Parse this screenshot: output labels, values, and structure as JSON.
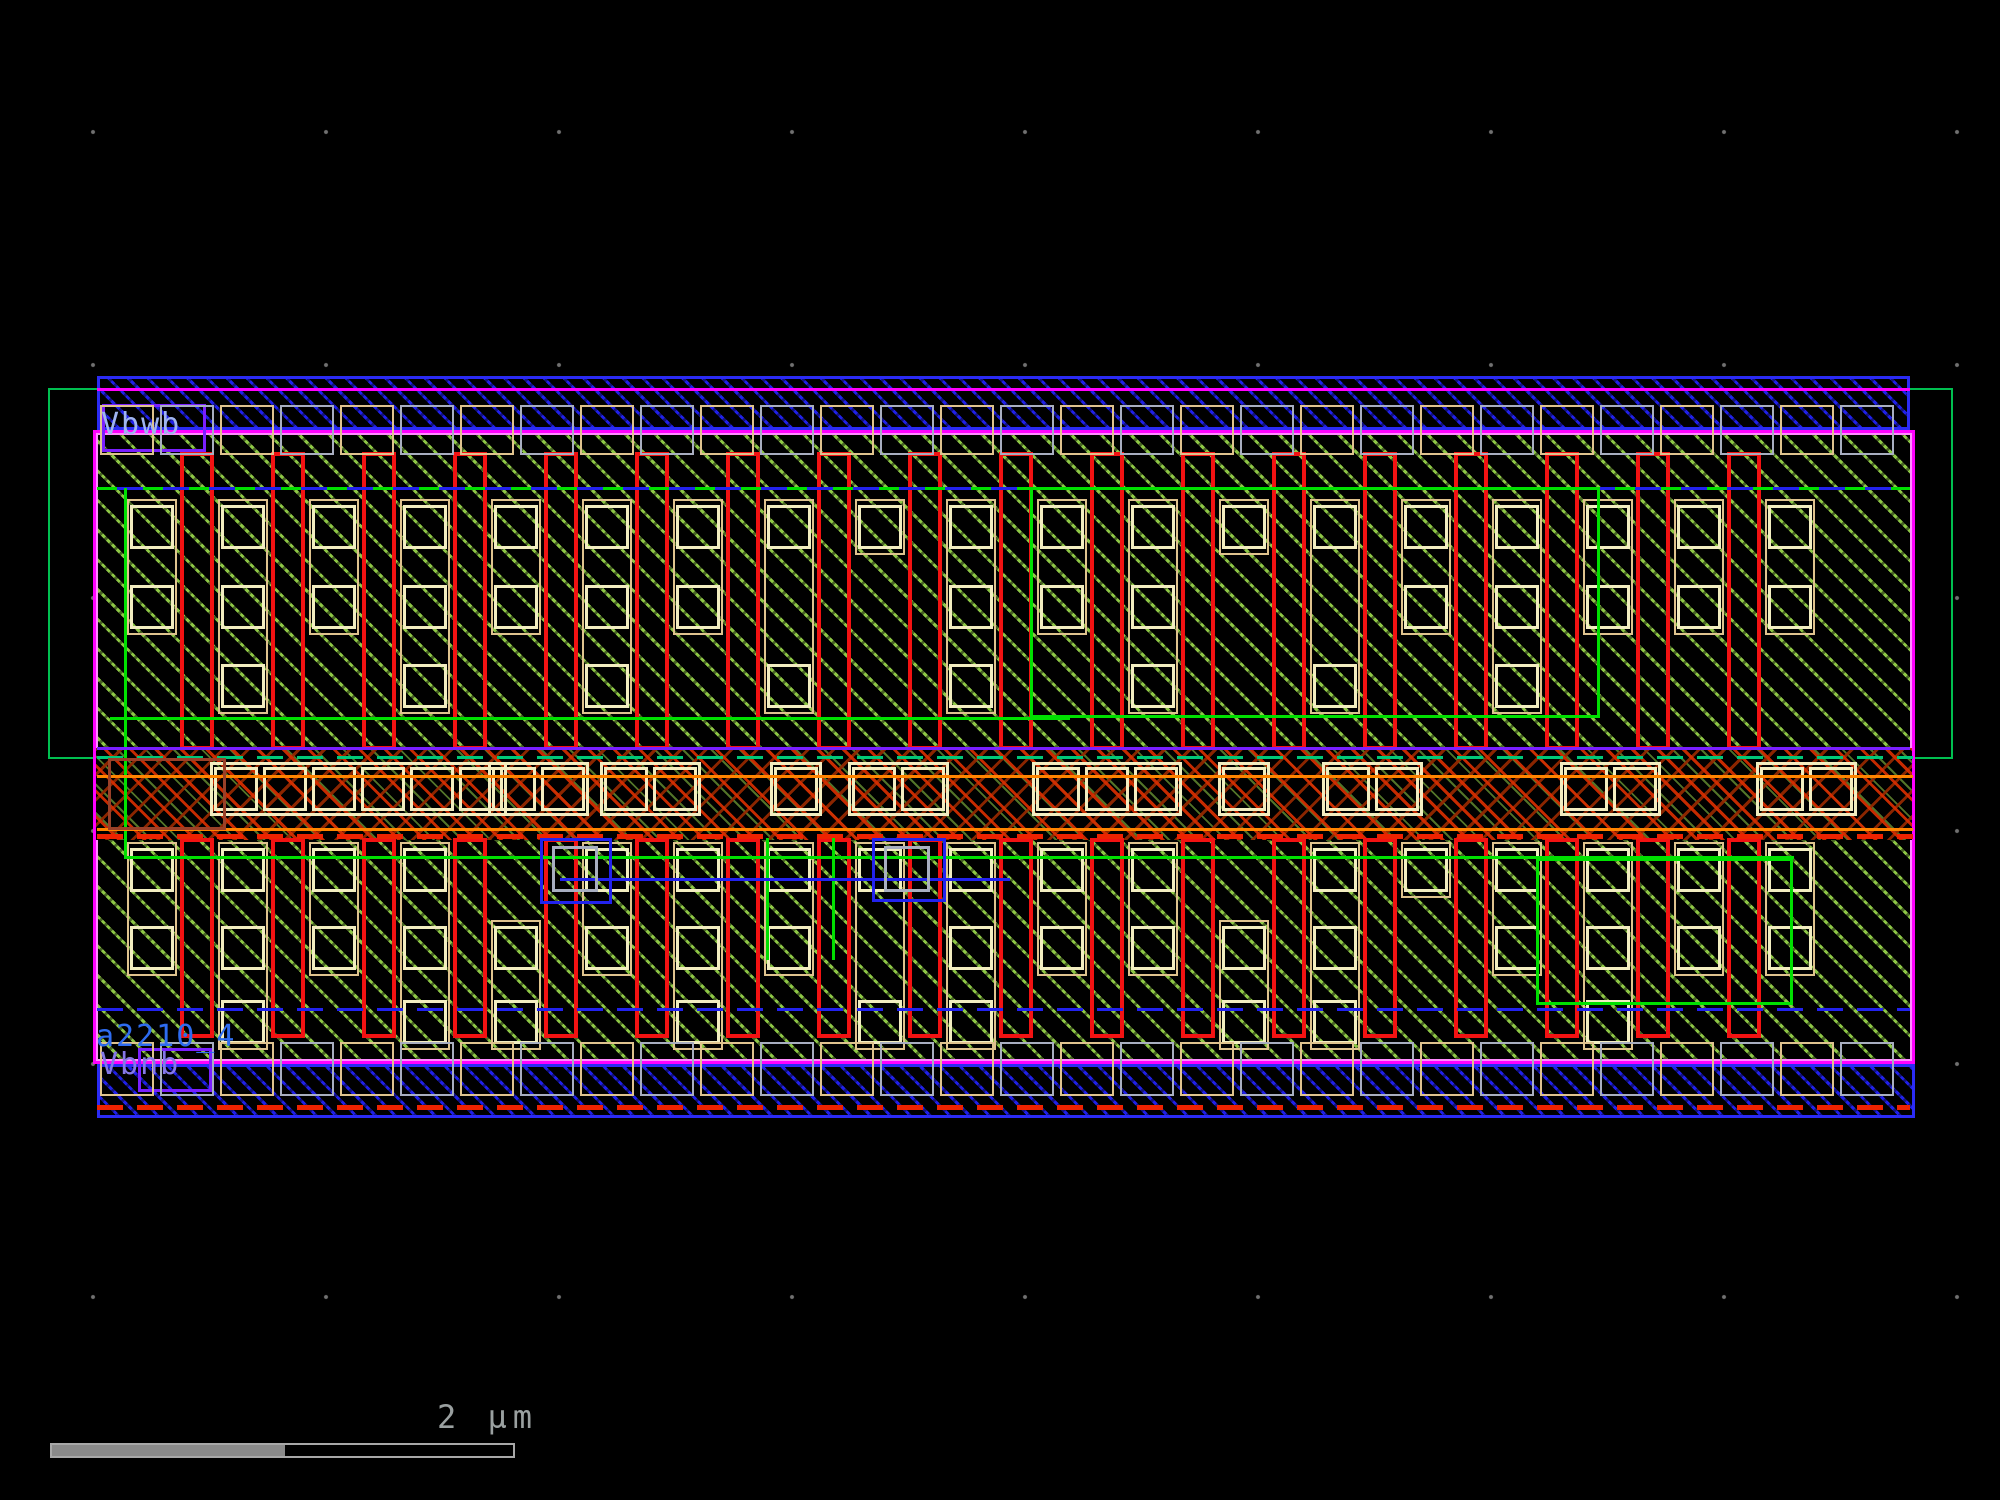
{
  "app": {
    "name": "ic-layout-viewer",
    "view": "standard-cell layout"
  },
  "labels": {
    "top_well_tap": {
      "text": "Vbwb",
      "x": 101,
      "y": 410,
      "color": "#9fb4f0"
    },
    "instance_name": {
      "text": "a2210_4",
      "x": 96,
      "y": 1022,
      "color": "#2e6cf0"
    },
    "bottom_sub_tap": {
      "text": "Vbnb",
      "x": 100,
      "y": 1050,
      "color": "#8577e8"
    }
  },
  "scalebar": {
    "label": "2 µm",
    "text_color": "#9aa0a0",
    "bar": {
      "x": 50,
      "y": 1443,
      "w": 465,
      "h": 15,
      "fill_w": 233,
      "fill_color": "#8a8a8a",
      "border_color": "#a8a8a8"
    },
    "text_pos": {
      "x": 437,
      "y": 1398
    }
  },
  "grid": {
    "pitch": 233,
    "origin_x": 93,
    "origin_y": 132,
    "dot_color": "#717171"
  },
  "colors": {
    "background": "#000000",
    "metal_rail_blue": "#2b2bf5",
    "well_green": "#00bf50",
    "brightGreen": "#00e000",
    "hatch_green": "#96d24a",
    "poly_red": "#f21212",
    "redBright": "#ee2200",
    "diff_tan": "#dfc38e",
    "contact_cream": "#f2edc0",
    "boundary_magenta": "#ff00ff",
    "boundary_pink": "#ff8cff",
    "blue": "#2222ee",
    "violet": "#7a1fff",
    "orange": "#ff8400",
    "teal": "#00c878",
    "grayTap": "#a8aec0",
    "tapTan": "#dfc38e",
    "brown": "#9a4028",
    "magenta": "#ff00ff"
  },
  "layout": {
    "outer_green_rect": {
      "x": 48,
      "y": 388,
      "w": 1905,
      "h": 371
    },
    "top_rail": {
      "x": 97,
      "y": 376,
      "w": 1813,
      "h": 54
    },
    "bottom_rail": {
      "x": 97,
      "y": 1064,
      "w": 1818,
      "h": 54
    },
    "cell_body": {
      "x": 93,
      "y": 430,
      "w": 1822,
      "h": 634
    },
    "band": {
      "x": 96,
      "y": 748,
      "w": 1816,
      "h": 92
    },
    "columns": {
      "contact_x0": 130,
      "poly_x0": 180,
      "pitch": 91,
      "contact_w": 44,
      "poly_w": 34,
      "square": 44,
      "n_contact": 19,
      "n_poly": 18,
      "poly_top": {
        "y": 452,
        "h": 298
      },
      "poly_bottom": {
        "y": 838,
        "h": 200
      },
      "rows_top": [
        505,
        585,
        664
      ],
      "rows_bottom": [
        848,
        926,
        1000
      ],
      "pattern_top": [
        [
          0,
          1
        ],
        [
          0,
          1,
          2
        ],
        [
          0,
          1
        ],
        [
          0,
          1,
          2
        ],
        [
          0,
          1
        ],
        [
          0,
          1,
          2
        ],
        [
          0,
          1
        ],
        [
          0,
          2
        ],
        [
          0
        ],
        [
          0,
          1,
          2
        ],
        [
          0,
          1
        ],
        [
          0,
          1,
          2
        ],
        [
          0
        ],
        [
          0,
          2
        ],
        [
          0,
          1
        ],
        [
          0,
          1,
          2
        ],
        [
          0,
          1
        ],
        [
          0,
          1
        ],
        [
          0,
          1
        ]
      ],
      "pattern_bottom": [
        [
          0,
          1
        ],
        [
          0,
          1,
          2
        ],
        [
          0,
          1
        ],
        [
          0,
          1,
          2
        ],
        [
          1,
          2
        ],
        [
          0,
          1
        ],
        [
          0,
          1,
          2
        ],
        [
          0,
          1
        ],
        [
          0,
          2
        ],
        [
          0,
          1,
          2
        ],
        [
          0,
          1
        ],
        [
          0,
          1
        ],
        [
          1,
          2
        ],
        [
          0,
          1,
          2
        ],
        [
          0
        ],
        [
          0,
          1
        ],
        [
          0,
          1,
          2
        ],
        [
          0,
          1
        ],
        [
          0,
          1
        ]
      ]
    },
    "band_strips": {
      "y": 762,
      "h": 54,
      "sq": 44,
      "gap": 5,
      "pad": 4,
      "items": [
        {
          "x": 210,
          "n": 6
        },
        {
          "x": 488,
          "n": 2
        },
        {
          "x": 600,
          "n": 2
        },
        {
          "x": 770,
          "n": 1
        },
        {
          "x": 848,
          "n": 2
        },
        {
          "x": 1032,
          "n": 3
        },
        {
          "x": 1218,
          "n": 1
        },
        {
          "x": 1322,
          "n": 2
        },
        {
          "x": 1560,
          "n": 2
        },
        {
          "x": 1756,
          "n": 2
        }
      ]
    },
    "taps": {
      "w": 54,
      "step": 60,
      "top": {
        "x0": 100,
        "x1": 1905,
        "y": 405,
        "h": 50
      },
      "bottom": {
        "x0": 100,
        "x1": 1910,
        "y": 1042,
        "h": 54
      }
    },
    "accents": [
      {
        "t": "h",
        "x": 97,
        "y": 388,
        "w": 1813,
        "th": 3,
        "c": "magenta",
        "name": "nwell-edge-line"
      },
      {
        "t": "hdashline",
        "x": 97,
        "y": 487,
        "w": 1813,
        "th": 3,
        "c": "blue",
        "dash": "brightGreen",
        "name": "implant-edge-dashed"
      },
      {
        "t": "v",
        "x": 124,
        "y": 488,
        "h": 370,
        "th": 3,
        "c": "brightGreen",
        "name": "pplus-edge"
      },
      {
        "t": "box",
        "x": 1030,
        "y": 487,
        "w": 570,
        "h": 231,
        "th": 3,
        "c": "brightGreen",
        "name": "pplus-region"
      },
      {
        "t": "h",
        "x": 110,
        "y": 717,
        "w": 960,
        "th": 3,
        "c": "brightGreen",
        "name": "pplus-edge"
      },
      {
        "t": "h",
        "x": 97,
        "y": 747,
        "w": 1813,
        "th": 3,
        "c": "violet",
        "name": "well-contact-line"
      },
      {
        "t": "hdash",
        "x": 97,
        "y": 756,
        "w": 1816,
        "th": 3,
        "c": "teal",
        "name": "outer-green-under-band"
      },
      {
        "t": "h",
        "x": 97,
        "y": 775,
        "w": 1816,
        "th": 3,
        "c": "orange",
        "name": "band-rail-top"
      },
      {
        "t": "h",
        "x": 97,
        "y": 828,
        "w": 1816,
        "th": 3,
        "c": "orange",
        "name": "band-rail-bottom"
      },
      {
        "t": "hdash",
        "x": 97,
        "y": 834,
        "w": 1816,
        "th": 5,
        "c": "redBright",
        "name": "band-edge-dashed"
      },
      {
        "t": "h",
        "x": 124,
        "y": 856,
        "w": 1670,
        "th": 3,
        "c": "brightGreen",
        "name": "nplus-edge"
      },
      {
        "t": "v",
        "x": 766,
        "y": 838,
        "h": 122,
        "th": 3,
        "c": "brightGreen",
        "name": "nplus-edge"
      },
      {
        "t": "v",
        "x": 832,
        "y": 838,
        "h": 122,
        "th": 3,
        "c": "brightGreen",
        "name": "nplus-edge"
      },
      {
        "t": "box",
        "x": 1536,
        "y": 858,
        "w": 257,
        "h": 147,
        "th": 3,
        "c": "brightGreen",
        "name": "nplus-region"
      },
      {
        "t": "box",
        "x": 540,
        "y": 838,
        "w": 72,
        "h": 66,
        "th": 3,
        "c": "blue",
        "name": "metal-route"
      },
      {
        "t": "box",
        "x": 872,
        "y": 838,
        "w": 74,
        "h": 64,
        "th": 3,
        "c": "blue",
        "name": "metal-route"
      },
      {
        "t": "h",
        "x": 560,
        "y": 878,
        "w": 450,
        "th": 3,
        "c": "blue",
        "name": "metal-route"
      },
      {
        "t": "box",
        "x": 552,
        "y": 846,
        "w": 46,
        "h": 46,
        "th": 3,
        "c": "grayTap",
        "name": "via-box"
      },
      {
        "t": "box",
        "x": 884,
        "y": 846,
        "w": 46,
        "h": 46,
        "th": 3,
        "c": "grayTap",
        "name": "via-box"
      },
      {
        "t": "hdash",
        "x": 97,
        "y": 1008,
        "w": 1813,
        "th": 3,
        "c": "blue",
        "name": "implant-edge-dashed"
      },
      {
        "t": "hdash",
        "x": 97,
        "y": 1105,
        "w": 1813,
        "th": 5,
        "c": "redBright",
        "name": "rail-dashed-line"
      },
      {
        "t": "box",
        "x": 108,
        "y": 758,
        "w": 118,
        "h": 72,
        "th": 3,
        "c": "brown",
        "name": "sub-contact"
      },
      {
        "t": "box",
        "x": 102,
        "y": 404,
        "w": 104,
        "h": 48,
        "th": 3,
        "c": "violet",
        "name": "pin-box"
      },
      {
        "t": "box",
        "x": 138,
        "y": 1048,
        "w": 74,
        "h": 44,
        "th": 3,
        "c": "violet",
        "name": "pin-box"
      }
    ]
  }
}
